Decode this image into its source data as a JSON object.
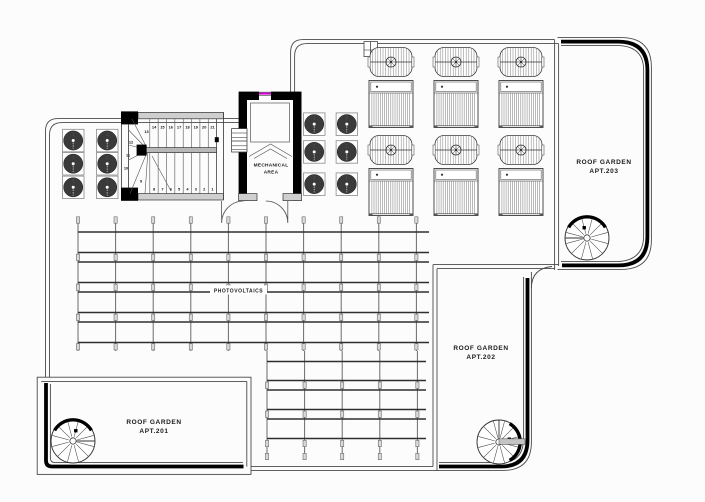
{
  "plan": {
    "areas": {
      "apt203": {
        "line1": "ROOF GARDEN",
        "line2": "APT.203"
      },
      "apt202": {
        "line1": "ROOF GARDEN",
        "line2": "APT.202"
      },
      "apt201": {
        "line1": "ROOF GARDEN",
        "line2": "APT.201"
      },
      "mechanical": {
        "line1": "MECHANICAL",
        "line2": "AREA"
      },
      "photovoltaics": {
        "label": "PHOTOVOLTAICS"
      }
    },
    "stair": {
      "run_top": [
        "14",
        "15",
        "16",
        "17",
        "18",
        "19",
        "20",
        "21"
      ],
      "winders": [
        "13",
        "12",
        "11",
        "10",
        "9"
      ],
      "run_bottom": [
        "8",
        "7",
        "6",
        "5",
        "4",
        "3",
        "2",
        "1"
      ]
    },
    "equipment": {
      "hvac_units_left": 6,
      "hvac_units_right": 6,
      "sun_loungers": 6,
      "parasols": 6,
      "spiral_stairs": 3,
      "pv_panel_rows_upper": 4,
      "pv_panel_cols_upper": 9,
      "pv_panel_rows_lower": 3,
      "pv_panel_cols_lower": 4
    },
    "colors": {
      "background": "#fcfcfc",
      "paper": "#ffffff",
      "outline": "#4a4a4a",
      "railing": "#000000",
      "wall_fill": "#cfcfcf",
      "wall_dark": "#000000",
      "hvac_fan": "#3a3a3a",
      "pv_rail": "#2f2f2f",
      "text": "#1a1a1a",
      "elevator_marker": "#cf00cf"
    }
  }
}
